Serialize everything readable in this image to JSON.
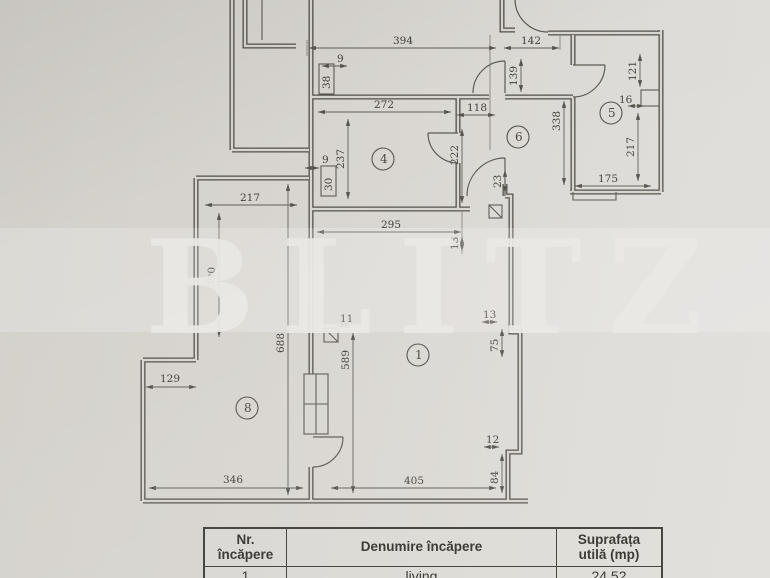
{
  "watermark": {
    "text": "BLITZ"
  },
  "plan": {
    "rooms": {
      "r4": "4",
      "r6": "6",
      "r5": "5",
      "r1": "1",
      "r8": "8"
    },
    "dims": {
      "d394": "394",
      "d9a": "9",
      "d38": "38",
      "d142": "142",
      "d139": "139",
      "d121": "121",
      "d16": "16",
      "d272": "272",
      "d118": "118",
      "d338": "338",
      "d237": "237",
      "d222": "222",
      "d23": "23",
      "d217r5": "217",
      "d175": "175",
      "d9b": "9",
      "d30": "30",
      "d295": "295",
      "d13a": "13",
      "d217r8": "217",
      "d390": "390",
      "d688": "688",
      "d11": "11",
      "d589": "589",
      "d13b": "13",
      "d75": "75",
      "d12": "12",
      "d84": "84",
      "d405": "405",
      "d346": "346",
      "d129": "129"
    }
  },
  "table": {
    "header": {
      "nr_line1": "Nr.",
      "nr_line2": "încăpere",
      "denumire": "Denumire încăpere",
      "supra_line1": "Suprafața",
      "supra_line2": "utilă (mp)"
    },
    "row1": {
      "nr": "1",
      "denumire": "living",
      "suprafata": "24,52"
    }
  }
}
